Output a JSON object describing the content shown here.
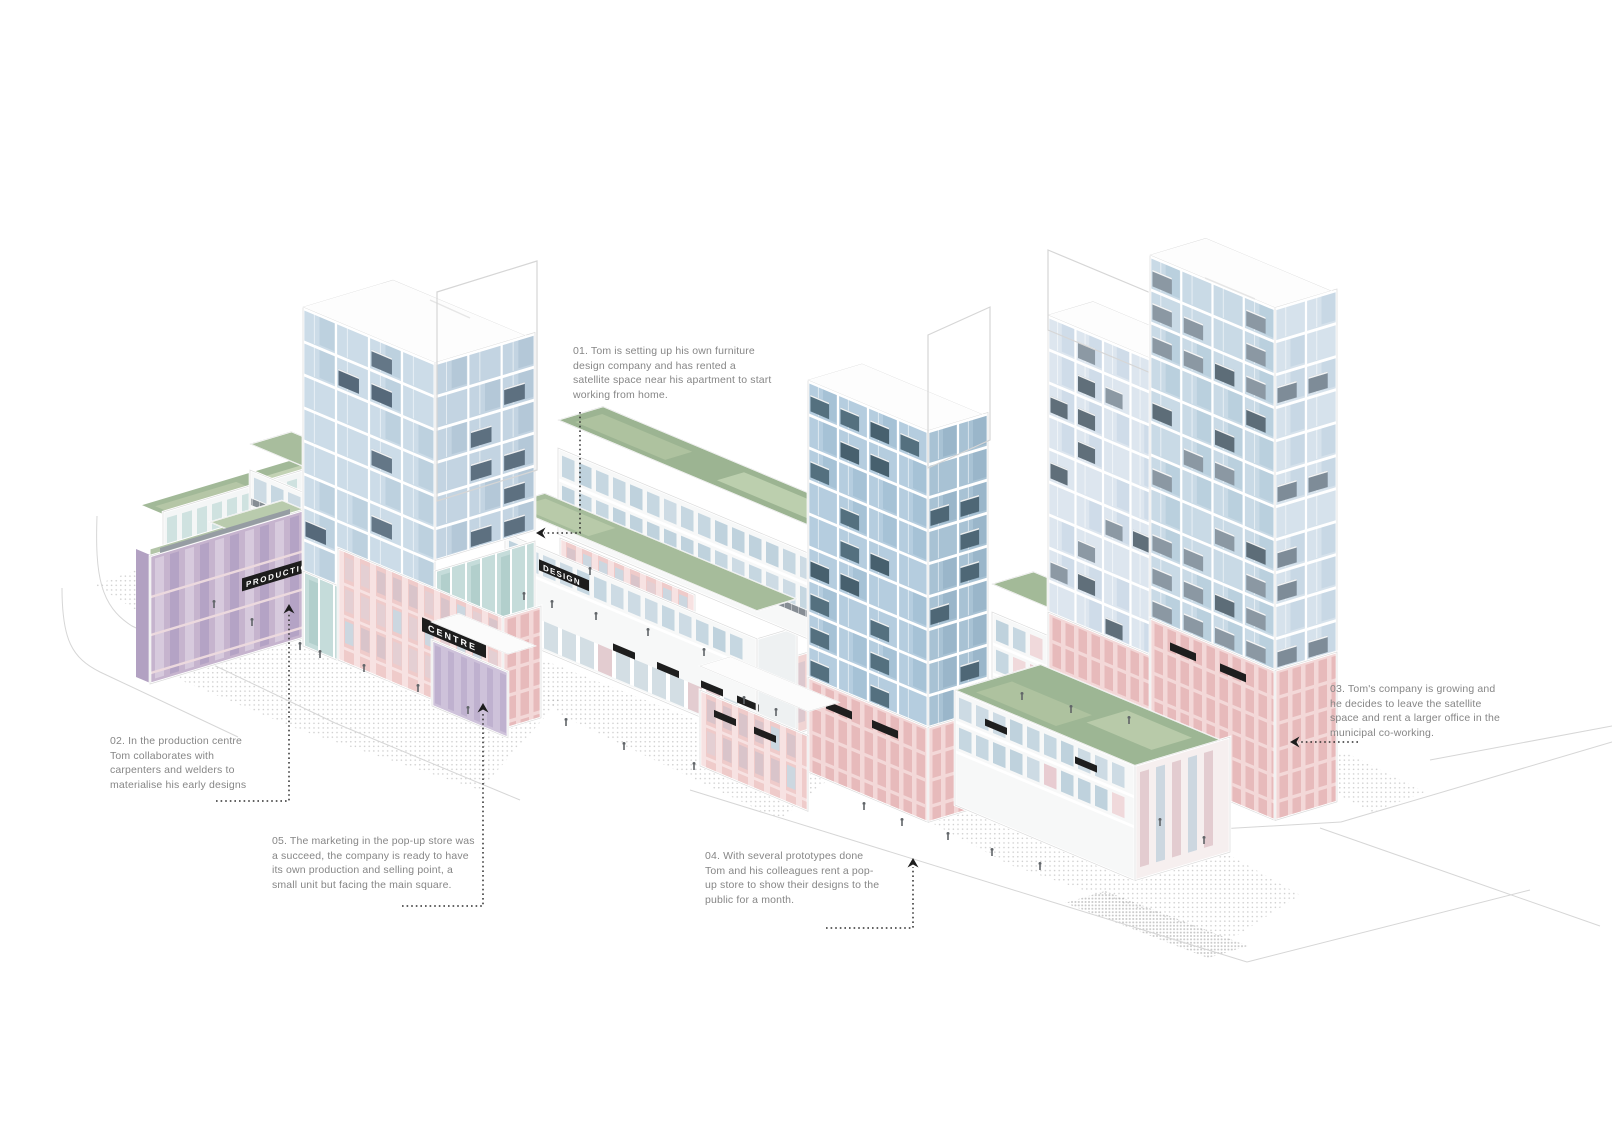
{
  "illustration": {
    "type": "axonometric urban block storyboard diagram",
    "background": "#ffffff"
  },
  "signs": {
    "production_centre": "PRODUCTION CENTRE",
    "centre": "CENTRE",
    "design": "DESIGN",
    "coworking": "CO-WO"
  },
  "notes": {
    "n01": "01. Tom is setting up his own furniture design company and has rented a satellite space near his apartment to start working from home.",
    "n02": "02. In the production centre Tom collaborates with carpenters and welders to materialise his early designs",
    "n03": "03. Tom's company is growing and he decides to leave the satellite space and rent a larger office in the municipal co-working.",
    "n04": "04. With several prototypes done Tom and his colleagues rent a pop-up store to show their designs to the public for a month.",
    "n05": "05. The marketing in the pop-up store was a succeed, the company is ready to have its own production and selling point, a small unit but facing the main square."
  },
  "colors": {
    "roof_green": "#9db694",
    "glass_blue": "#b5cddf",
    "pale_glass": "#dde6ef",
    "facade_pink": "#efcbca",
    "podium_pink": "#e7babb",
    "facade_purple": "#c6b4ce",
    "balcony_slate": "#54707f",
    "sign_black": "#1d1d1d",
    "note_gray": "#868686",
    "road_gray": "#d6d6d6"
  }
}
